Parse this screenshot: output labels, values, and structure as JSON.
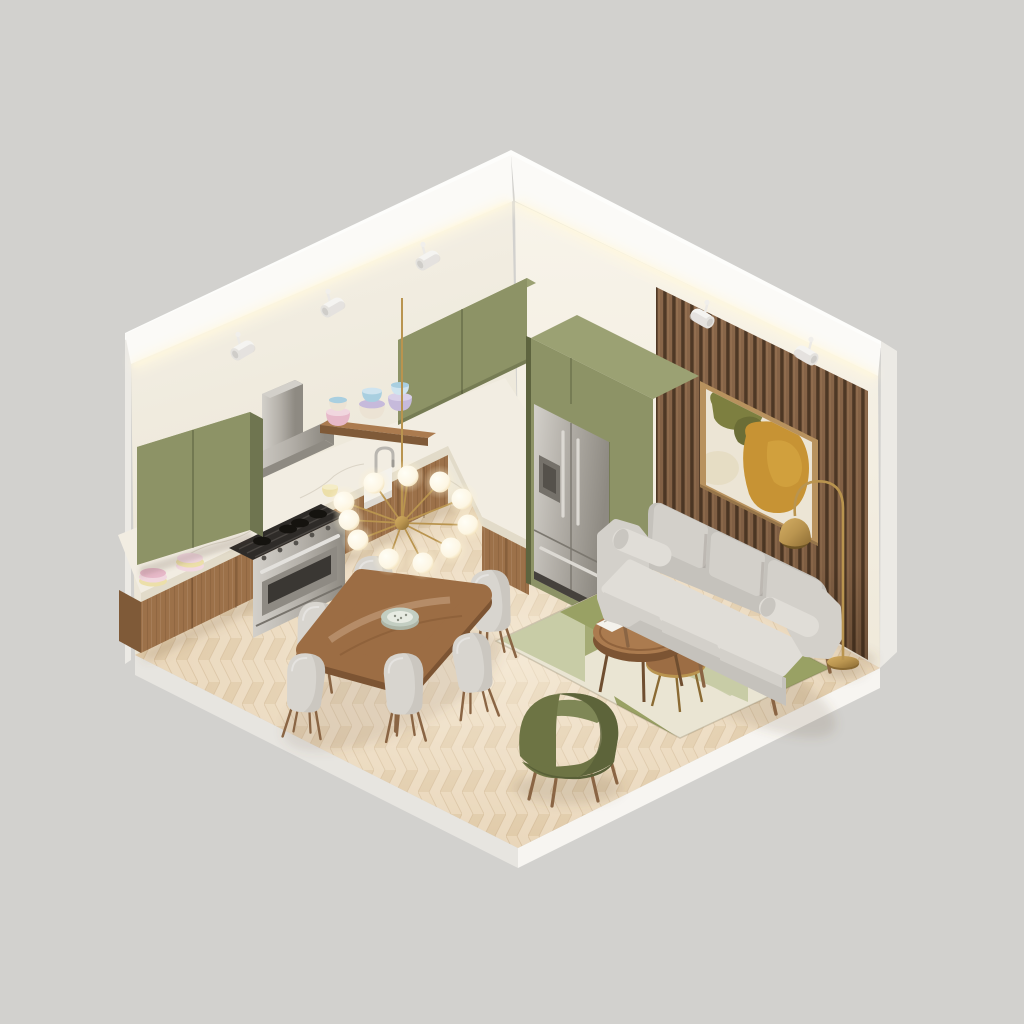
{
  "scene": {
    "description": "Isometric 3D cutaway render of an open-plan interior with a kitchen along the left wall, a dining set in the middle and a living room against a wood-slat accent wall",
    "style": "soft neutral 3D render, sage green / walnut / cream palette, no visible text",
    "room": {
      "left_wall": "cream plaster with cove LED strip and track spotlights",
      "right_wall": "cream plaster with walnut slat accent panel",
      "floor": "light oak herringbone parquet on a white plinth slab"
    },
    "lighting": {
      "cove_led_strip": "warm white, both walls",
      "track_spotlights_left_wall": 3,
      "track_spotlights_right_wall": 2,
      "chandelier": "brass sputnik with 11 glowing glass globes over dining table",
      "floor_lamp": "brass arc lamp with dome shade beside sofa"
    },
    "kitchen": {
      "upper_cabinets": "sage green flat-front, wall unit + corner unit + tall fridge surround",
      "base_cabinets": "walnut with white marble countertop",
      "appliances": [
        "stainless range hood",
        "stainless gas range with oven",
        "stainless french-door refrigerator with water dispenser",
        "white farmhouse sink with chrome faucet"
      ],
      "decor": [
        "three pastel bowl stacks on walnut shelf",
        "pink and yellow plate stacks on counter",
        "small yellow cup"
      ]
    },
    "dining": {
      "table": "oval walnut dining table",
      "chairs": 6,
      "chair_finish": "light grey upholstery, walnut legs",
      "centerpiece": "speckled ceramic bowl"
    },
    "living": {
      "sofa": "3-seat light grey sofa with two bolster pillows and walnut legs",
      "coffee_tables": "two round walnut nesting tables with brass accents",
      "coffee_table_decor": [
        "open magazine",
        "two white vases",
        "green potted plant"
      ],
      "accent_chair": "olive green velvet barrel chair",
      "rug": "geometric rug in cream, sage and olive",
      "wall_art": "abstract painting (olive + mustard shapes) in oak frame"
    },
    "palette": {
      "bg": "#d2d1ce",
      "wallL1": "#f5f1e7",
      "wallL2": "#eae4d4",
      "wallR1": "#f8f4ea",
      "wallR2": "#efe9da",
      "band": "#fbfaf7",
      "bandTop": "#fdfdfb",
      "outerEdge": "#eceae5",
      "plinthL": "#e7e5e0",
      "plinthR": "#f7f5f1",
      "led": "#fff8dd",
      "floorBase": "#ead8bd",
      "plankA": "#e9d6b9",
      "plankB": "#e0caa8",
      "floorSeam": "#c9ae88",
      "olive": "#8d9366",
      "oliveDark": "#6f7550",
      "oliveTop": "#9ba173",
      "oliveDeep": "#5e643f",
      "wood": "#9c7149",
      "woodDark": "#7f5a38",
      "woodEdge": "#6f4e30",
      "marble": "#f2ede2",
      "marbleEdge": "#e2dbc9",
      "steelLight": "#d3d0ca",
      "steel": "#b3afa8",
      "steelDark": "#8e8a82",
      "slat": "#8a674a",
      "slatDark": "#4f3926",
      "slatLight": "#a07c59",
      "frame": "#b8925e",
      "frameDark": "#96754a",
      "canvas": "#ece5d5",
      "artOlive": "#7d7f40",
      "artOliveDark": "#6b6d36",
      "artMustard": "#c79334",
      "artMustardLight": "#d3a440",
      "artBeige": "#e3d9bc",
      "sofa": "#d3d0ca",
      "sofaLight": "#e0ddd7",
      "sofaMid": "#c5c2bc",
      "sofaDark": "#a9a6a0",
      "rugBase": "#eae5d3",
      "rugOlive": "#99a164",
      "rugSage": "#c8cca6",
      "rugCream": "#f2eee1",
      "chair": "#d8d5cf",
      "leg": "#8a6544",
      "table": "#9c6d44",
      "tableLight": "#ab7b4f",
      "tableEdge": "#7c5433",
      "brass": "#b9944f",
      "brassDark": "#8a6a33",
      "globe": "#fdf6e3",
      "glow": "#fff3d2",
      "armOlive": "#6d7444",
      "armOliveLight": "#7f8756",
      "armOliveDark": "#596038",
      "plant": "#5f7342",
      "plantDark": "#485a33",
      "white": "#f4f2ec",
      "pink": "#e7b9c9",
      "pinkLight": "#f1d7df",
      "blue": "#a9cfe0",
      "lavender": "#c6badb",
      "creamware": "#ece3d4",
      "yellowware": "#ecdfa9",
      "bowlTeal": "#c3cec2",
      "shadow": "#6b5540"
    }
  }
}
